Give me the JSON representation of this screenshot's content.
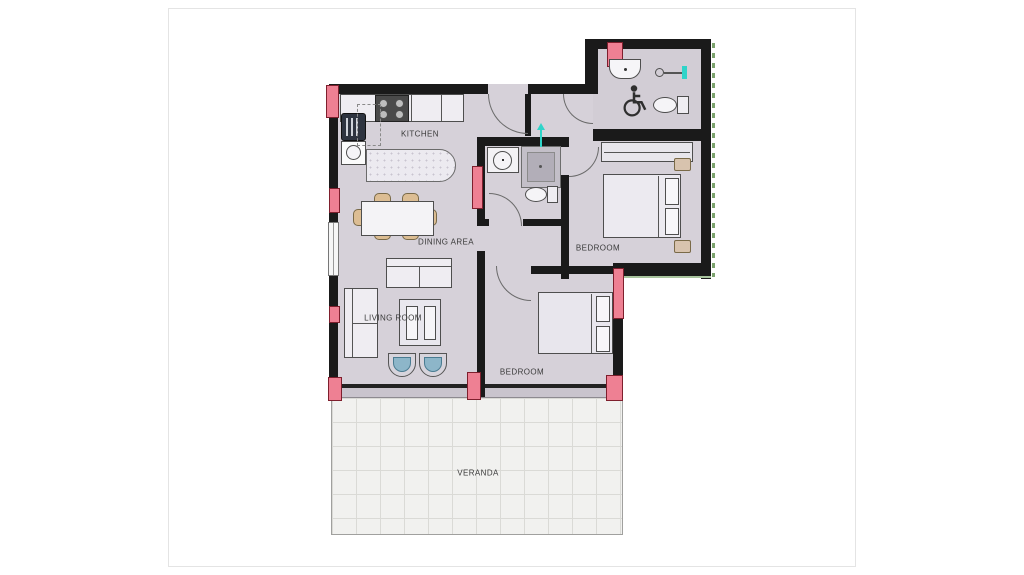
{
  "plan": {
    "labels": {
      "kitchen": "KITCHEN",
      "dining": "DINING AREA",
      "living": "LIVING ROOM",
      "bedroom_right": "BEDROOM",
      "bedroom_bottom": "BEDROOM",
      "veranda": "VERANDA"
    },
    "colors": {
      "wall": "#1a1a1a",
      "floor": "#d6d1d9",
      "accent_pink": "#ee8093",
      "accent_teal": "#2fd4c9",
      "furniture_tan": "#dcbd93",
      "chair_teal": "#8db6c9",
      "veranda_tile": "#f1f1ef"
    }
  }
}
